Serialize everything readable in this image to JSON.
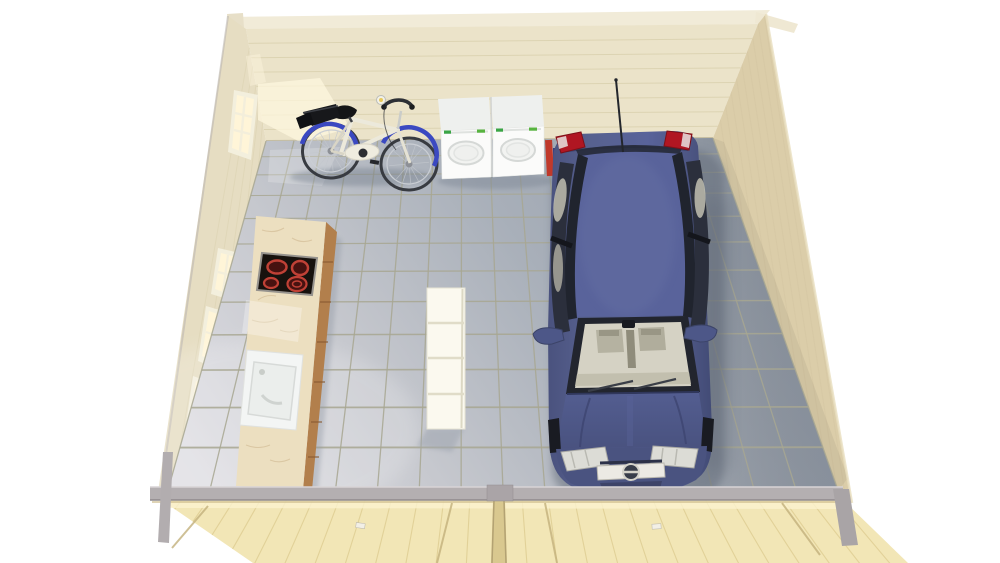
{
  "scene": {
    "description": "3d-render-log-cabin-garage-interior-top-view",
    "objects": {
      "cabin": "wooden-log-cabin",
      "floor": "grey-tiled-floor",
      "car": "dark-blue-hatchback-car",
      "bicycle": "blue-white-city-bicycle",
      "washer_left": "washing-machine",
      "washer_right": "tumble-dryer",
      "kitchen": "kitchenette-counter",
      "hob": "ceramic-hob-4-burners",
      "sink": "white-sink",
      "shelf": "white-shelf-unit",
      "front_doors": "double-garage-doors-top-view",
      "windows": "glazed-side-windows"
    }
  },
  "palette": {
    "background": "#ffffff",
    "roof_rim": "#f1ebd8",
    "wall_wood_back": "#ebe3c9",
    "wall_wood_left": "#e6ddc2",
    "wall_wood_right": "#dbcda9",
    "wall_plank_line": "#dbd2b0",
    "window_frame": "#f3efdd",
    "window_glass": "#fff5d8",
    "grout": "#a8a792",
    "floor_light": "#e0dfe4",
    "floor_dark": "#929ba7",
    "beam_gray": "#b4afb1",
    "front_wall_wood": "#f2e6b6",
    "counter_marble": "#ecdfc0",
    "cabinet_wood": "#b27f4c",
    "hob_black": "#17120e",
    "burner_red": "#c04136",
    "sink_white": "#f3f5f4",
    "appliance_white": "#fbfbfa",
    "appliance_green": "#3aa545",
    "shelf_white": "#fbf9ef",
    "bike_blue": "#3b49c1",
    "bike_frame": "#ece9db",
    "car_body": "#59639b",
    "car_glass": "#2b2f3c",
    "car_interior": "#d5d2c4",
    "taillight_red": "#b01622",
    "headlight": "#dcdcd6",
    "chrome": "#d4d2c9",
    "shadow": "#5f6876"
  }
}
